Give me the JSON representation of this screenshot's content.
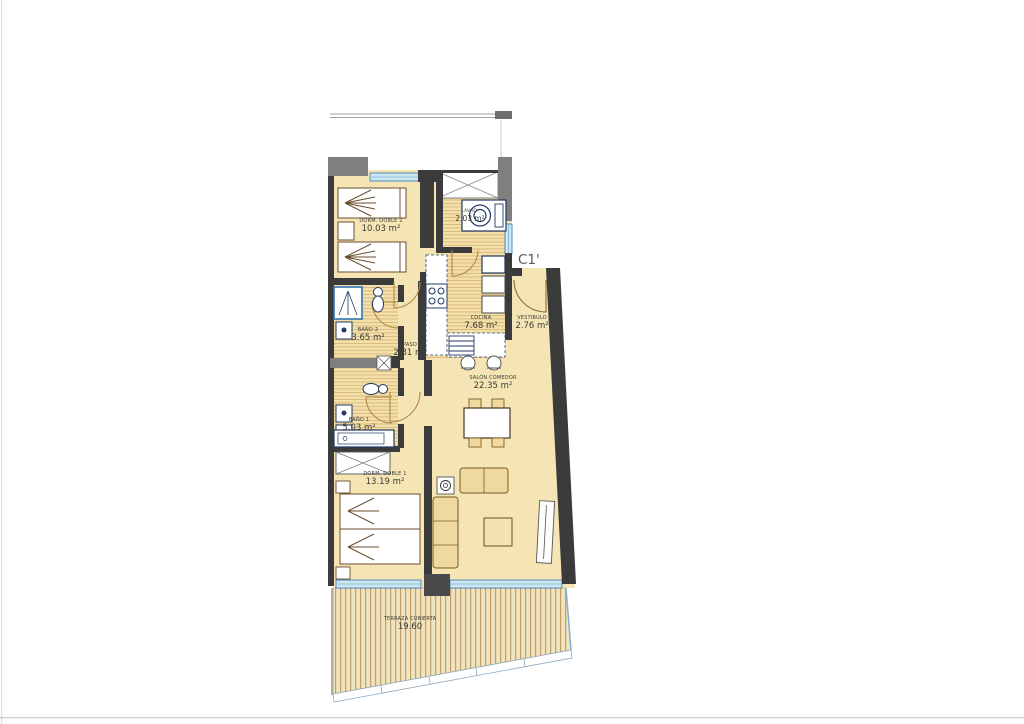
{
  "plan": {
    "unit_label": "C1'",
    "rooms": [
      {
        "id": "dorm2",
        "name": "DORM. DOBLE 2",
        "area": "10.03 m²"
      },
      {
        "id": "lavadero",
        "name": "LAVAD.",
        "area": "2.03 m²"
      },
      {
        "id": "bano2",
        "name": "BAÑO 2",
        "area": "3.65 m²"
      },
      {
        "id": "paso",
        "name": "PASO",
        "area": "2.81 m²"
      },
      {
        "id": "cocina",
        "name": "COCINA",
        "area": "7.68 m²"
      },
      {
        "id": "vestibulo",
        "name": "VESTIBULO",
        "area": "2.76 m²"
      },
      {
        "id": "salon",
        "name": "SALÓN COMEDOR",
        "area": "22.35 m²"
      },
      {
        "id": "bano1",
        "name": "BAÑO 1",
        "area": "5.03 m²"
      },
      {
        "id": "dorm1",
        "name": "DORM. DOBLE 1",
        "area": "13.19 m²"
      },
      {
        "id": "terraza",
        "name": "TERRAZA CUBIERTA",
        "area": "19.60"
      }
    ],
    "colors": {
      "wall": "#3b3b3b",
      "pillar": "#7f7f7f",
      "room_fill": "#F6E5B4",
      "wet_room_stripe": "#D9B87C",
      "window_fill": "#CDE7F0",
      "window_line": "#2E75B6",
      "fixture_line": "#1F3864",
      "door_arc": "#B08948",
      "furniture_line": "#6B4E2E",
      "upholstery_fill": "#EFD9A0",
      "terrace_stripe": "#C2A06A",
      "text": "#3a3a3a",
      "unit_label_color": "#595959"
    }
  }
}
